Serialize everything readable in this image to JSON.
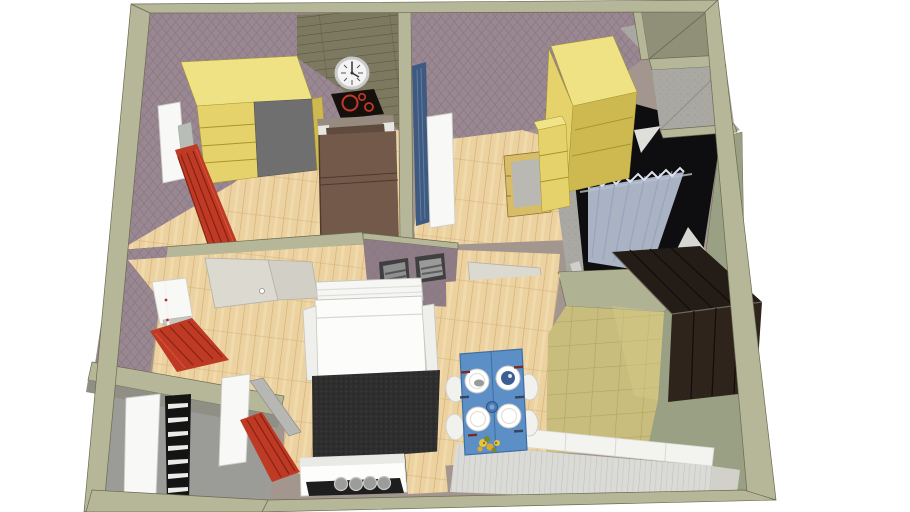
{
  "app": {
    "name": "3D floor plan viewer",
    "description": "Top-down perspective 3D rendering of a one-bedroom apartment model with furnished rooms, white background, SketchUp-style flat shading"
  },
  "scene": {
    "view": "top-down perspective, cutaway walls",
    "background": "white",
    "rooms": [
      {
        "id": "bedroom-1",
        "label": "Bedroom (top left)",
        "floor": "light wood planks",
        "walls": "mauve patterned wallpaper",
        "features": [
          "yellow wardrobe with open gray cabinet",
          "double bed with brown duvet and pillow",
          "window with white frame and red curtain",
          "dark wood plank feature wall",
          "round wall clock",
          "black panel with red burner rings"
        ]
      },
      {
        "id": "bedroom-2",
        "label": "Second room (top middle)",
        "floor": "light wood planks",
        "walls": "mauve patterned wallpaper",
        "features": [
          "blue tall locker",
          "white door",
          "yellow wardrobe",
          "desk with gray top"
        ]
      },
      {
        "id": "bathroom",
        "label": "Bathroom (top right)",
        "floor": "black",
        "walls": "gray concrete",
        "features": [
          "light blue shower curtain on rod",
          "white corner shelves",
          "ceiling lamp"
        ]
      },
      {
        "id": "utility-shafts",
        "label": "Utility shafts (top right corner)",
        "features": [
          "olive shaft",
          "concrete shaft"
        ]
      },
      {
        "id": "hallway",
        "label": "Hallway (center)",
        "floor": "light wood planks",
        "features": [
          "open pale doors",
          "partition wall with two framed pictures"
        ]
      },
      {
        "id": "living-room",
        "label": "Living room (bottom left)",
        "floor": "light wood planks",
        "features": [
          "white sofa bed",
          "dark charcoal rug",
          "window with red curtain",
          "white TV stand with tray and four round knobs"
        ]
      },
      {
        "id": "balcony",
        "label": "Balcony (bottom left corner)",
        "floor": "gray",
        "features": [
          "white door leaf",
          "black ladder with white rungs",
          "red curtain",
          "metal rail"
        ]
      },
      {
        "id": "kitchen",
        "label": "Kitchen (bottom right)",
        "floor": "olive ceramic tiles and wood",
        "features": [
          "blue dining table with four white plates",
          "white chairs",
          "blue cup and bowl",
          "yellow flowers",
          "dark brown tall wardrobe",
          "white counter with plank worktop"
        ]
      }
    ]
  },
  "colors": {
    "bg": "#ffffff",
    "wallOlive": "#b6b798",
    "wallOliveDark": "#9e9e85",
    "wallEdge": "#6a6a50",
    "wallpaperBase": "#998791",
    "wallpaperLine": "#897681",
    "wallpaperDarkBase": "#8e7d87",
    "woodBase": "#ecd2a0",
    "woodStreak": "#cba368",
    "woodLight": "#f6e4ba",
    "plankWallBase": "#7d7960",
    "plankWallLine": "#55513a",
    "floorGray": "#9b9b97",
    "concrete": "#a9a8a2",
    "concreteDot": "#9b9a94",
    "bathBlack": "#0e0e10",
    "curtainBlue": "#b7c1d4",
    "curtainFold": "#93a0bb",
    "yellowTop": "#efe284",
    "yellowFront": "#e6d26a",
    "yellowShade": "#cdb94f",
    "yellowLine": "#a8952f",
    "grayCabinet": "#6f6f6f",
    "red": "#bf3a24",
    "redDark": "#7c1d0e",
    "redLight": "#d9573a",
    "white": "#f8f8f6",
    "whiteShade": "#cfcfca",
    "bedDuvet": "#73594a",
    "bedPillow": "#5f4a3e",
    "bedSheet": "#e8e6e0",
    "bedHead": "#978b7f",
    "rugBase": "#2e2e2e",
    "rugDot": "#3b3b3b",
    "tileBase": "#c9bd7d",
    "tileLine": "#b1a562",
    "tileLight": "#d6ca8a",
    "darkWardrobeTop": "#241c16",
    "darkWardrobeFront": "#2e241c",
    "darkWardrobeLine": "#120d09",
    "tableBlue": "#5d8fc7",
    "tableBlueDark": "#3f6ea6",
    "bowlBlue": "#3c5f93",
    "cupBlue": "#4a7ab5",
    "counterPlank": "#dadad6",
    "counterPlankLine": "#bcbcb7",
    "beige": "#d2d1c9",
    "paleDoor": "#dcd9d0",
    "paleDoor2": "#d2cfc6",
    "metal": "#b7b7b3",
    "lockerBlue": "#3e5a80",
    "lockerBlueLight": "#6b88ad",
    "deskWood": "#d9bd66",
    "deskTop": "#b9b8b3",
    "flowerYellow": "#e7c33a",
    "flowerOrange": "#e2a82a",
    "flowerGreen": "#7a8a2e",
    "clockFace": "#f4f4f4",
    "clockRim": "#c9c9c9",
    "stoveBlack": "#16100d",
    "stoveRed": "#c23a27",
    "shaftOlive": "#8f9077",
    "shaftLine": "#6d6e55",
    "kitchenWallFace": "#9aa083",
    "kitchenTopFace": "#b0b294"
  }
}
